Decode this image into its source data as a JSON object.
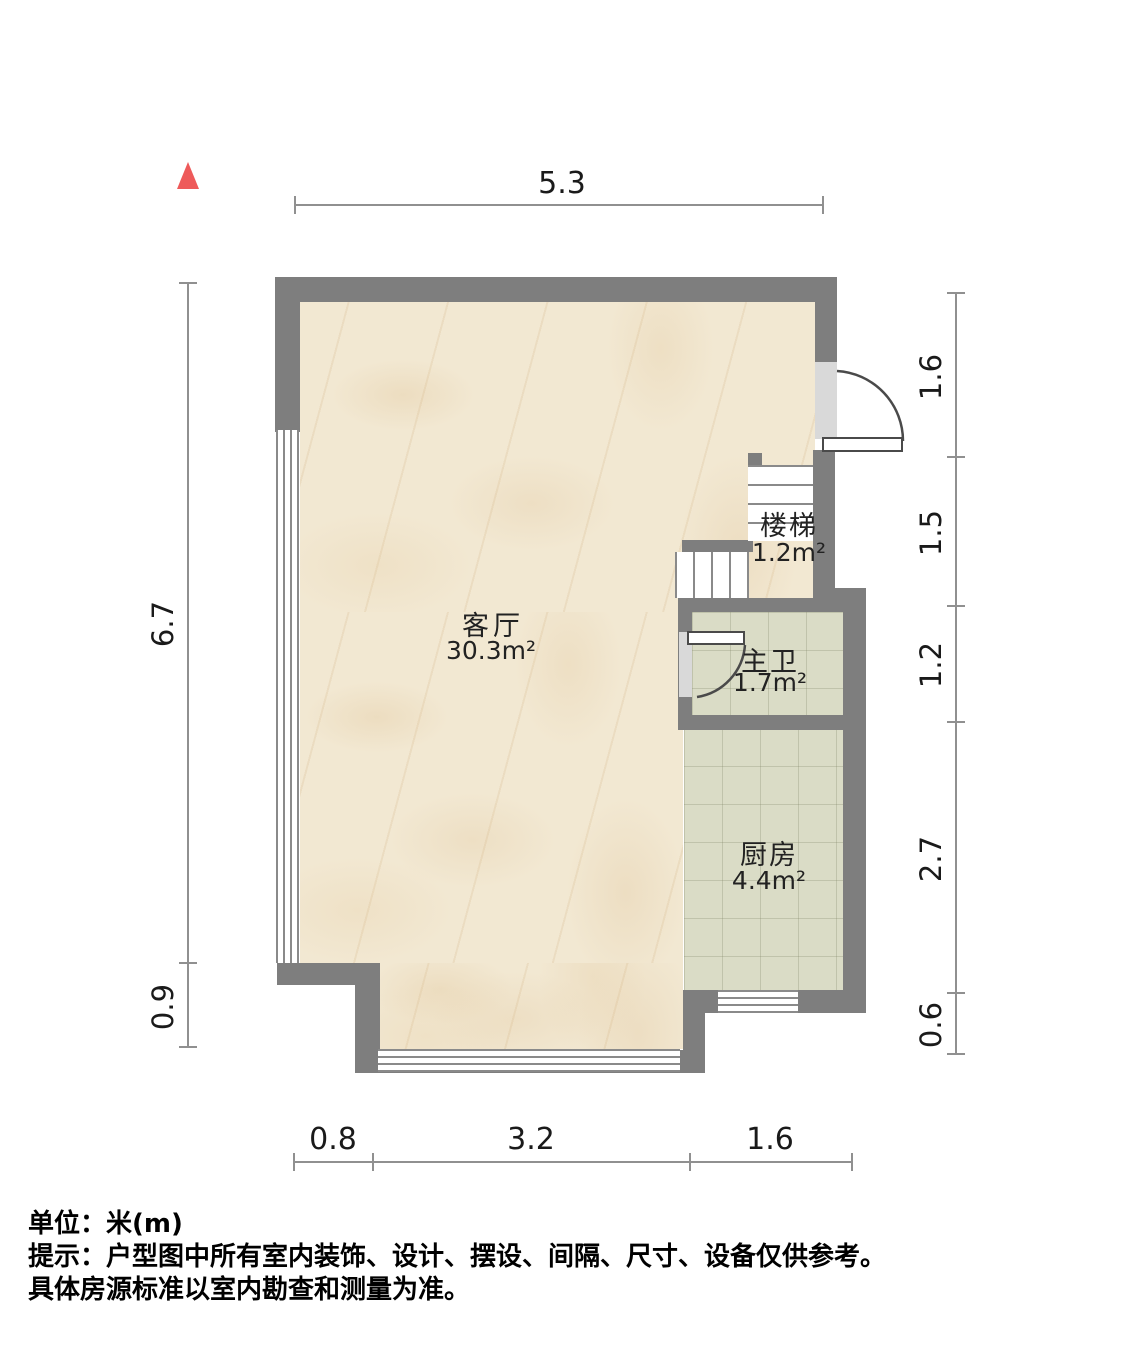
{
  "plan": {
    "rooms": [
      {
        "name": "客厅",
        "area": "30.3m²"
      },
      {
        "name": "楼梯",
        "area": "1.2m²"
      },
      {
        "name": "主卫",
        "area": "1.7m²"
      },
      {
        "name": "厨房",
        "area": "4.4m²"
      }
    ],
    "dimensions": {
      "top": [
        "5.3"
      ],
      "left": [
        "6.7",
        "0.9"
      ],
      "right": [
        "1.6",
        "1.5",
        "1.2",
        "2.7",
        "0.6"
      ],
      "bottom": [
        "0.8",
        "3.2",
        "1.6"
      ]
    }
  },
  "footer": {
    "unit_label": "单位：米(m)",
    "note_line_1": "提示：户型图中所有室内装饰、设计、摆设、间隔、尺寸、设备仅供参考。",
    "note_line_2": "具体房源标准以室内勘查和测量为准。"
  },
  "colors": {
    "wall": "#7e7e7e",
    "marble_floor": "#f2e8d2",
    "tile_floor": "#dadcc6",
    "north_arrow": "#ee5a5a",
    "dimension_line": "#909090"
  }
}
